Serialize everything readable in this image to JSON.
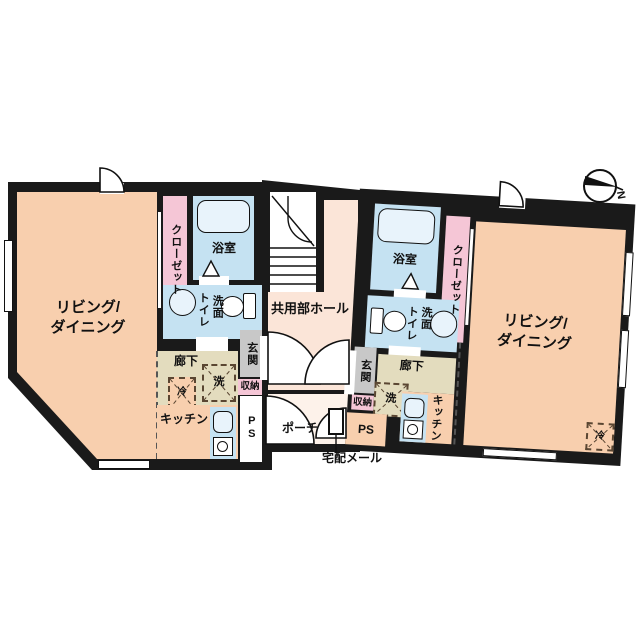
{
  "colors": {
    "wall": "#1a1a1a",
    "peach": "#f8cfae",
    "blue": "#c5e2f2",
    "fixture": "#e8f3fb",
    "pink": "#f5c6d6",
    "khaki": "#e3dcbe",
    "gray": "#c8c8c8",
    "hall": "#fbe5d8",
    "porch": "#fdf2ea"
  },
  "compass": {
    "north_label": "N"
  },
  "common": {
    "hall_label": "共用部ホール",
    "porch_label": "ポーチ",
    "delivery_label": "宅配メール"
  },
  "left_unit": {
    "living_line1": "リビング/",
    "living_line2": "ダイニング",
    "closet_label": "クローゼット",
    "bath_label": "浴室",
    "toilet_label": "トイレ",
    "wash_label": "洗面",
    "hallway_label": "廊下",
    "entrance_label": "玄関",
    "storage_label": "収納",
    "washer_label": "洗",
    "fridge_label": "冷",
    "kitchen_label": "キッチン",
    "ps_label": "PS"
  },
  "right_unit": {
    "living_line1": "リビング/",
    "living_line2": "ダイニング",
    "closet_label": "クローゼット",
    "bath_label": "浴室",
    "toilet_label": "トイレ",
    "wash_label": "洗面",
    "hallway_label": "廊下",
    "entrance_label": "玄関",
    "storage_label": "収納",
    "washer_label": "洗",
    "fridge_label": "冷",
    "kitchen_label": "キッチン",
    "ps_label": "PS"
  }
}
